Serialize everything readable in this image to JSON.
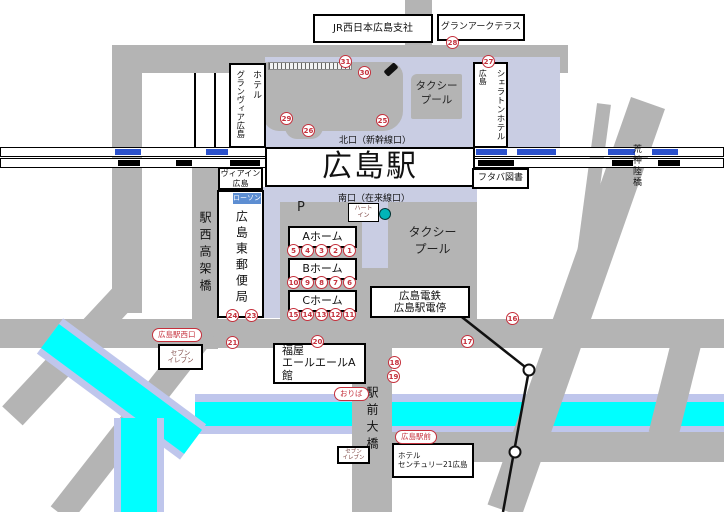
{
  "colors": {
    "road": "#b4b4b4",
    "plaza": "#c9cde3",
    "river": "#00ffff",
    "riveredge": "#bfc6ec",
    "red": "#c5303c",
    "railblue": "#2c52cc",
    "lawson": "#5d8ed2",
    "teal": "#00b4b8"
  },
  "station": {
    "name": "広島駅",
    "north_exit": "北口（新幹線口）",
    "south_exit": "南口（在来線口）"
  },
  "buildings": {
    "jr_west": "JR西日本広島支社",
    "gran_arc": "グランアークテラス",
    "sheraton": {
      "main": "シェラトンホテル",
      "sub": "広島"
    },
    "granvia": {
      "main": "ホテル",
      "sub": "グランヴィア広島"
    },
    "via_inn": [
      "ヴィアイン",
      "広島"
    ],
    "post_office": "広島東郵便局",
    "lawson": "ローソン",
    "futaba": "フタバ図書",
    "heart_in": [
      "ハート",
      "イン"
    ],
    "hiroden": [
      "広島電鉄",
      "広島駅電停"
    ],
    "fukuya": [
      "福屋",
      "エールエールA館"
    ],
    "century": [
      "ホテル",
      "センチュリー21広島"
    ],
    "seven_eleven": [
      "セブン",
      "イレブン"
    ]
  },
  "labels": {
    "taxi_pool": [
      "タクシー",
      "プール"
    ],
    "parking": "P",
    "ekinishi_viaduct": "駅西高架橋",
    "kojin_bridge": "荒神陸橋",
    "ekimae_bridge": "駅前大橋"
  },
  "badges": {
    "west_exit": "広島駅西口",
    "oriba": "おりば",
    "ekimae": "広島駅前"
  },
  "platforms": [
    {
      "name": "Aホーム",
      "stops": [
        "5",
        "4",
        "3",
        "2",
        "1"
      ]
    },
    {
      "name": "Bホーム",
      "stops": [
        "10",
        "9",
        "8",
        "7",
        "6"
      ]
    },
    {
      "name": "Cホーム",
      "stops": [
        "15",
        "14",
        "13",
        "12",
        "11"
      ]
    }
  ],
  "street_stops": {
    "s16": "16",
    "s17": "17",
    "s18": "18",
    "s19": "19",
    "s20": "20",
    "s21": "21",
    "s23": "23",
    "s24": "24",
    "s25": "25",
    "s26": "26",
    "s27": "27",
    "s28": "28",
    "s29": "29",
    "s30": "30",
    "s31": "31"
  }
}
